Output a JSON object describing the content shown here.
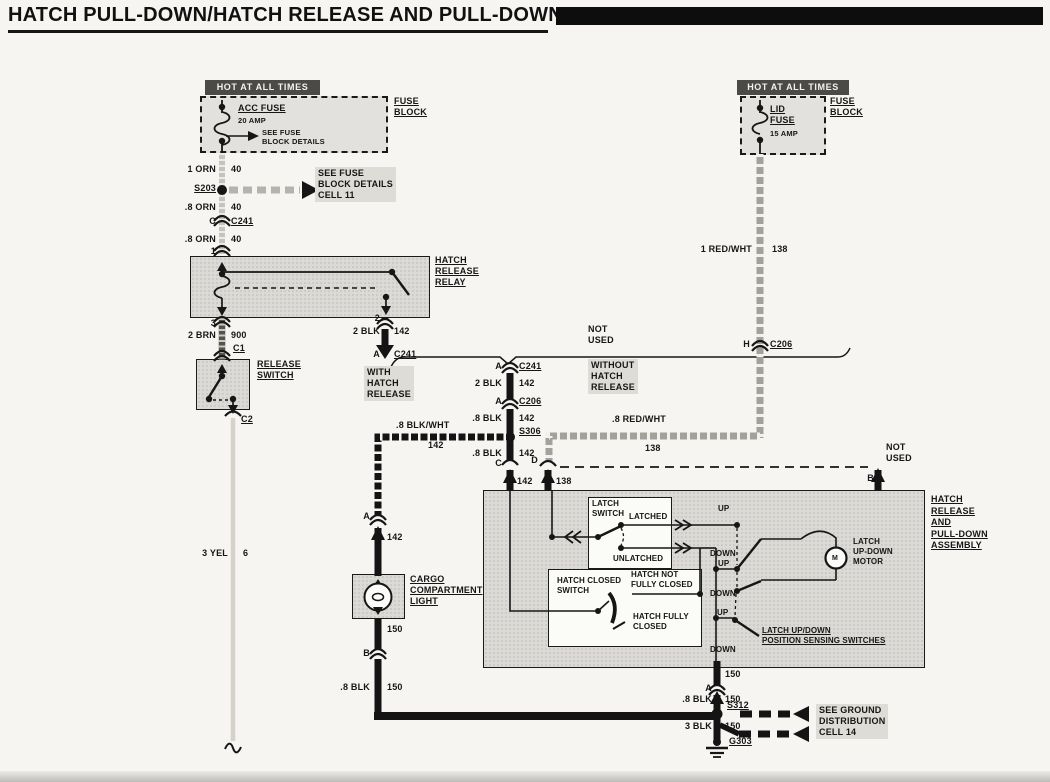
{
  "title": "HATCH PULL-DOWN/HATCH RELEASE AND PULL-DOWN",
  "colors": {
    "paper": "#f6f5f2",
    "ink": "#161616",
    "component_fill": "#dbdad6",
    "hot_header_bg": "#4b4a47",
    "wire_black": "#141414",
    "wire_orange_scan": "#c6c4be",
    "wire_brown_scan": "#56534d",
    "wire_yellow_scan": "#d5d2ca",
    "wire_redwht_scan": "#a3a19b"
  },
  "left": {
    "hot": "HOT AT ALL TIMES",
    "fuse_name": "ACC FUSE",
    "fuse_rating": "20 AMP",
    "fuse_note": "SEE FUSE\nBLOCK DETAILS",
    "fuse_block": "FUSE\nBLOCK",
    "w1": "1 ORN",
    "w1c": "40",
    "s203": "S203",
    "cell11": "SEE FUSE\nBLOCK DETAILS\nCELL 11",
    "w2": ".8 ORN",
    "w2c": "40",
    "tC": "C",
    "c241": "C241",
    "w3": ".8 ORN",
    "w3c": "40",
    "t1": "1",
    "t3": "3",
    "relay": "HATCH\nRELEASE\nRELAY",
    "w4": "2 BRN",
    "w4c": "900",
    "c1": "C1",
    "release_switch": "RELEASE\nSWITCH",
    "c2": "C2",
    "w5": "3 YEL",
    "w5c": "6"
  },
  "center": {
    "t2": "2",
    "w6": "2 BLK",
    "w6c": "142",
    "tA1": "A",
    "c241b": "C241",
    "with_hatch": "WITH\nHATCH\nRELEASE",
    "not_used": "NOT\nUSED",
    "without_hatch": "WITHOUT\nHATCH\nRELEASE",
    "tA2": "A",
    "c241c": "C241",
    "w7": "2 BLK",
    "w7c": "142",
    "tA3": "A",
    "c206": "C206",
    "w8": ".8 BLK",
    "w8c": "142",
    "s306": "S306",
    "w9": ".8 BLK",
    "w9c": "142",
    "tC2": "C",
    "tCc": "142",
    "w10": ".8 BLK/WHT",
    "w10c": "142",
    "tA4": "A",
    "tA4c": "142",
    "cargo": "CARGO\nCOMPARTMENT\nLIGHT",
    "w11c": "150",
    "tB1": "B",
    "w12": ".8 BLK",
    "w12c": "150"
  },
  "right": {
    "hot": "HOT AT ALL TIMES",
    "fuse_name": "LID\nFUSE",
    "fuse_rating": "15 AMP",
    "fuse_block": "FUSE\nBLOCK",
    "w13": "1 RED/WHT",
    "w13c": "138",
    "tH": "H",
    "c206": "C206",
    "w14": ".8 RED/WHT",
    "w14c": "138",
    "tD": "D",
    "tDc": "138",
    "not_used": "NOT\nUSED",
    "tB2": "B"
  },
  "assembly": {
    "label": "HATCH\nRELEASE\nAND\nPULL-DOWN\nASSEMBLY",
    "latch_switch": "LATCH\nSWITCH",
    "latched": "LATCHED",
    "unlatched": "UNLATCHED",
    "up1": "UP",
    "down1": "DOWN",
    "up2": "UP",
    "down2": "DOWN",
    "up3": "UP",
    "down3": "DOWN",
    "hatch_closed_switch": "HATCH CLOSED\nSWITCH",
    "hatch_not_fully_closed": "HATCH NOT\nFULLY CLOSED",
    "hatch_fully_closed": "HATCH FULLY\nCLOSED",
    "motor": "LATCH\nUP-DOWN\nMOTOR",
    "motor_m": "M",
    "sensing": "LATCH UP/DOWN\nPOSITION SENSING SWITCHES"
  },
  "ground": {
    "w15c": "150",
    "tA5": "A",
    "w16": ".8 BLK",
    "w16c": "150",
    "s312": "S312",
    "w17": "3 BLK",
    "w17c": "150",
    "g303": "G303",
    "note": "SEE GROUND\nDISTRIBUTION\nCELL 14"
  }
}
